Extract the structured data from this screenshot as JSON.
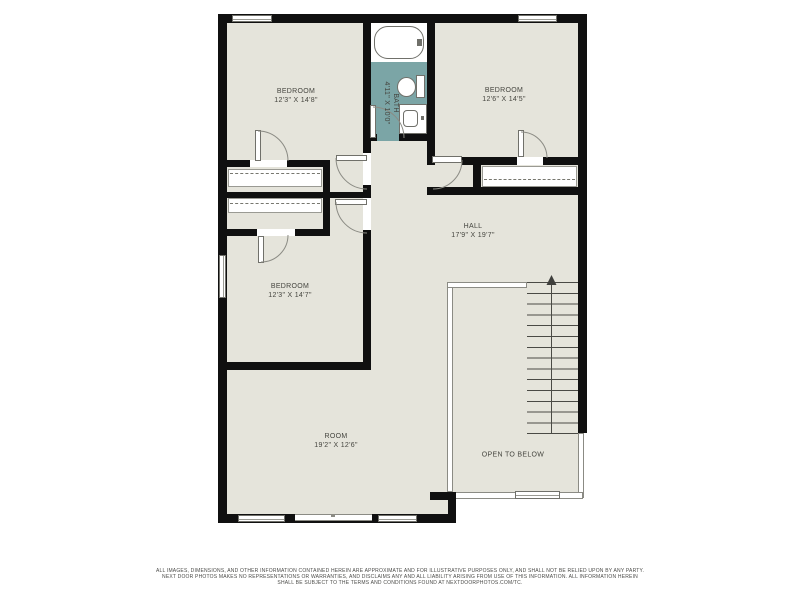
{
  "plan": {
    "type": "floor-plan",
    "colors": {
      "wall": "#101010",
      "floor": "#e5e4db",
      "bath_floor": "#7ba5a6",
      "thin_line": "#8b8b84",
      "label_text": "#45453f"
    },
    "rooms": {
      "bedroom1": {
        "name": "BEDROOM",
        "dims": "12'3\" X 14'8\""
      },
      "bath": {
        "name": "BATH",
        "dims": "4'11\" X 10'0\""
      },
      "bedroom2": {
        "name": "BEDROOM",
        "dims": "12'6\" X 14'5\""
      },
      "bedroom3": {
        "name": "BEDROOM",
        "dims": "12'3\" X 14'7\""
      },
      "hall": {
        "name": "HALL",
        "dims": "17'9\" X 19'7\""
      },
      "room": {
        "name": "ROOM",
        "dims": "19'2\" X 12'6\""
      },
      "open_to_below": {
        "name": "OPEN TO BELOW"
      }
    },
    "stairs": {
      "direction": "up",
      "tread_count": 14
    },
    "fixture_icons": [
      "bathtub-icon",
      "toilet-icon",
      "sink-icon",
      "up-arrow-icon"
    ]
  },
  "disclaimer": {
    "line1": "ALL IMAGES, DIMENSIONS, AND OTHER INFORMATION CONTAINED HEREIN ARE APPROXIMATE AND FOR ILLUSTRATIVE PURPOSES ONLY, AND SHALL NOT BE RELIED UPON BY ANY PARTY.",
    "line2": "NEXT DOOR PHOTOS MAKES NO REPRESENTATIONS OR WARRANTIES, AND DISCLAIMS ANY AND ALL LIABILITY ARISING FROM USE OF THIS INFORMATION. ALL INFORMATION HEREIN",
    "line3": "SHALL BE SUBJECT TO THE TERMS AND CONDITIONS FOUND AT NEXTDOORPHOTOS.COM/TC."
  }
}
